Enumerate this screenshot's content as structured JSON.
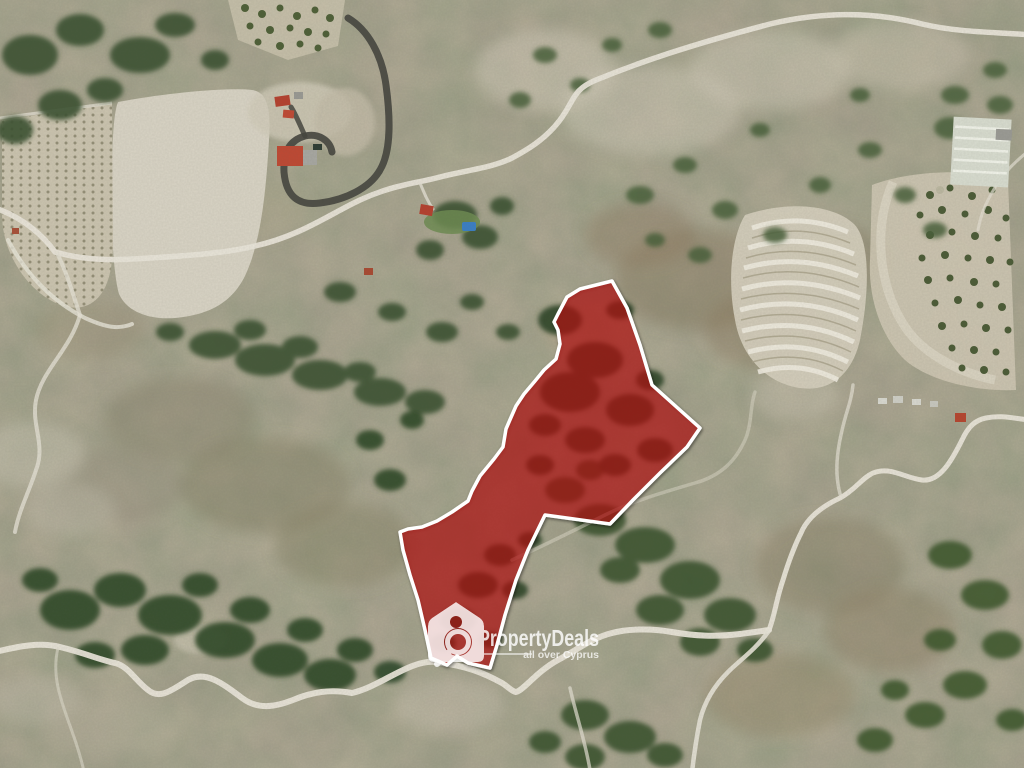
{
  "watermark": {
    "brand": "PropertyDeals",
    "tagline": "all over Cyprus",
    "logo_icon": "tag-magnifier-icon",
    "text_color": "#ffffff",
    "opacity": 0.8
  },
  "overlay": {
    "parcel_fill": "rgba(185,18,18,0.6)",
    "parcel_outline": "#ffffff",
    "polygon_points": [
      [
        612,
        281
      ],
      [
        627,
        308
      ],
      [
        640,
        345
      ],
      [
        652,
        385
      ],
      [
        700,
        428
      ],
      [
        687,
        447
      ],
      [
        660,
        473
      ],
      [
        633,
        500
      ],
      [
        610,
        524
      ],
      [
        545,
        515
      ],
      [
        528,
        550
      ],
      [
        516,
        580
      ],
      [
        505,
        615
      ],
      [
        497,
        645
      ],
      [
        490,
        668
      ],
      [
        468,
        663
      ],
      [
        457,
        656
      ],
      [
        447,
        665
      ],
      [
        431,
        658
      ],
      [
        425,
        630
      ],
      [
        418,
        600
      ],
      [
        410,
        575
      ],
      [
        403,
        550
      ],
      [
        400,
        532
      ],
      [
        408,
        529
      ],
      [
        422,
        527
      ],
      [
        437,
        521
      ],
      [
        452,
        512
      ],
      [
        468,
        501
      ],
      [
        472,
        491
      ],
      [
        480,
        476
      ],
      [
        494,
        459
      ],
      [
        503,
        447
      ],
      [
        506,
        429
      ],
      [
        509,
        422
      ],
      [
        516,
        406
      ],
      [
        524,
        394
      ],
      [
        535,
        381
      ],
      [
        544,
        370
      ],
      [
        556,
        359
      ],
      [
        560,
        344
      ],
      [
        558,
        330
      ],
      [
        554,
        322
      ],
      [
        558,
        314
      ],
      [
        567,
        297
      ],
      [
        580,
        289
      ]
    ]
  },
  "scene": {
    "type": "satellite-aerial-photo",
    "terrain_base": "#a29b8a",
    "vegetation_color": "#3c5331",
    "road_color": "#eae6da",
    "field_color": "#d9d4c5",
    "driveway_color": "#45453e"
  }
}
